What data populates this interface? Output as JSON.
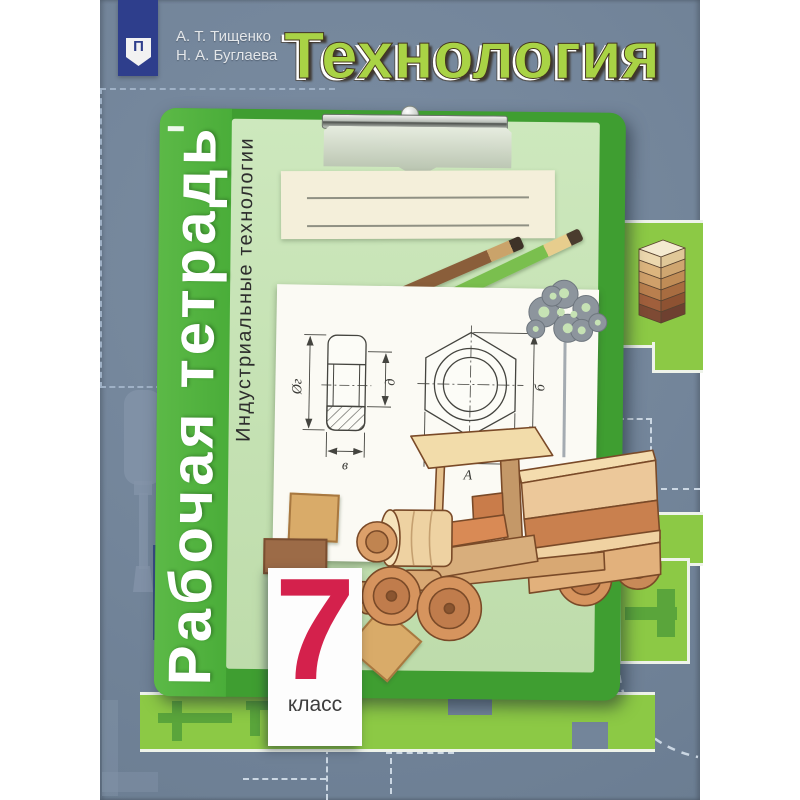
{
  "cover": {
    "background_color": "#73859a",
    "publisher": {
      "logo_letter": "П",
      "banner_color": "#2e3e8c"
    },
    "authors": {
      "line1": "А. Т. Тищенко",
      "line2": "Н. А. Буглаева"
    },
    "title": {
      "text": "Технология",
      "color": "#a9d345"
    },
    "spine": {
      "series": "Рабочая тетрадь",
      "subtitle": "Индустриальные технологии"
    },
    "grade": {
      "number": "7",
      "word": "класс",
      "accent_color": "#d4214c"
    }
  },
  "technical_drawing": {
    "labels": {
      "diameter": "Øг",
      "side_height": "д",
      "side_width": "в",
      "hex_height": "б",
      "hex_width": "А"
    }
  },
  "icons": {
    "publisher_logo": "prosveshchenie-logo",
    "clip": "clipboard-clip",
    "ornament": "metal-snowflake-ornament",
    "stacked_wood": "stacked-wood-layers",
    "truck": "wooden-toy-truck"
  }
}
